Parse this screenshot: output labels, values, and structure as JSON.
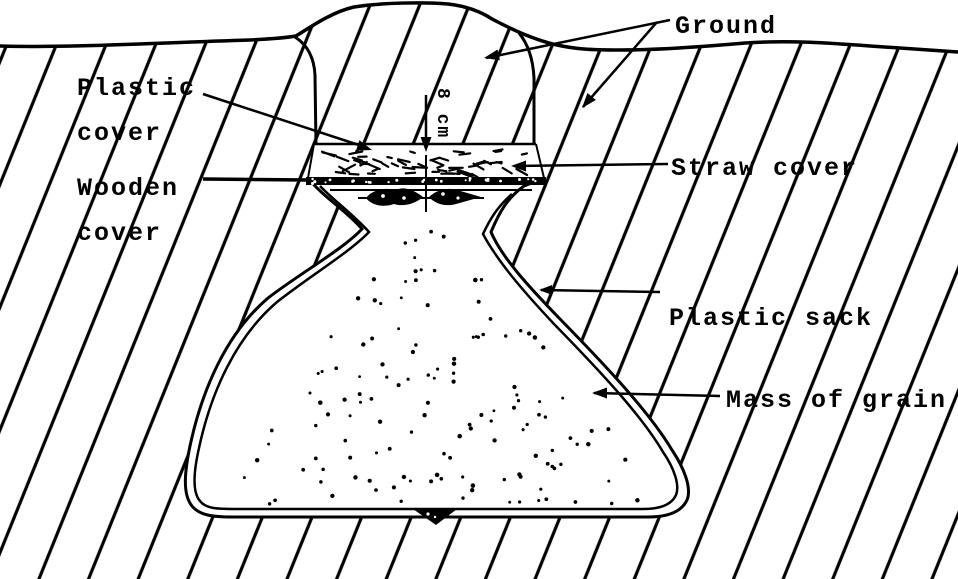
{
  "diagram": {
    "labels": {
      "ground": "Ground",
      "plastic_cover": "Plastic\ncover",
      "wooden_cover": "Wooden\ncover",
      "straw_cover": "Straw cover",
      "plastic_sack": "Plastic sack",
      "mass_of_grain": "Mass of grain",
      "straw_depth": "8 cm"
    },
    "colors": {
      "ink": "#000000",
      "paper": "#ffffff"
    }
  }
}
